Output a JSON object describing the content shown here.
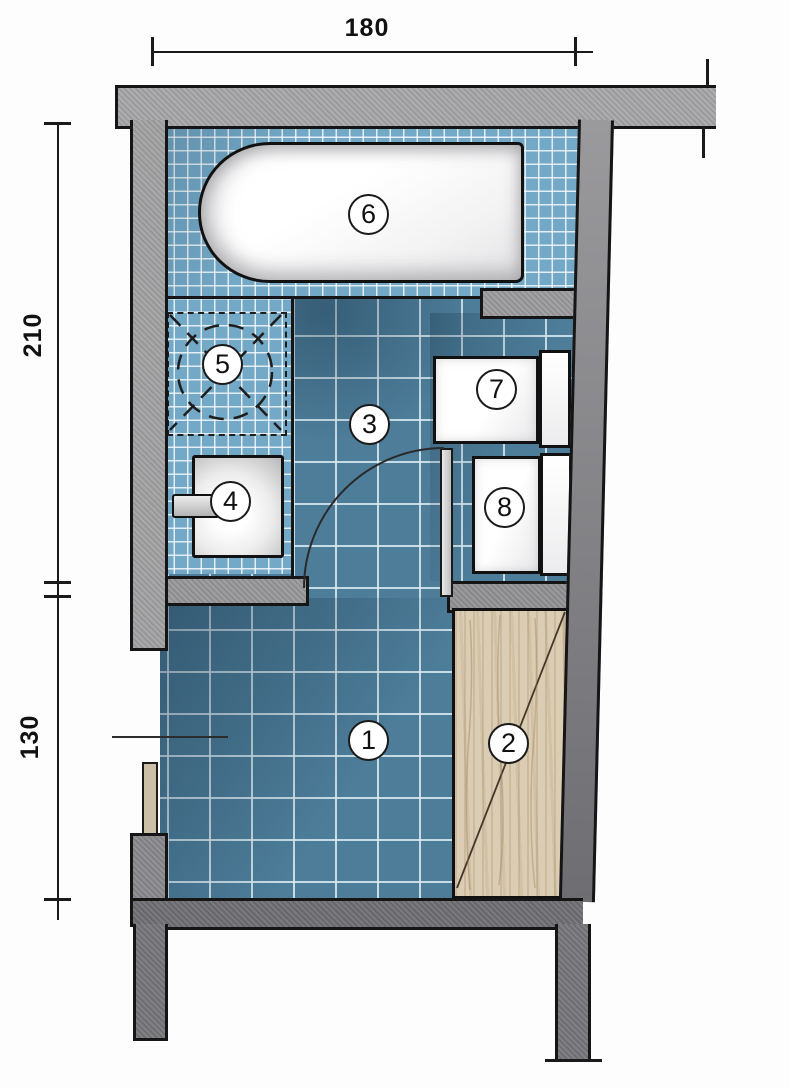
{
  "diagram": {
    "type": "bathroom-floor-plan",
    "dimensions": {
      "width_top": "180",
      "height_upper_left": "210",
      "height_lower_left": "130"
    },
    "markers": [
      {
        "number": "1",
        "item": "main-floor-area"
      },
      {
        "number": "2",
        "item": "wood-panel"
      },
      {
        "number": "3",
        "item": "upper-floor-area"
      },
      {
        "number": "4",
        "item": "washbasin"
      },
      {
        "number": "5",
        "item": "washing-machine"
      },
      {
        "number": "6",
        "item": "bathtub"
      },
      {
        "number": "7",
        "item": "toilet"
      },
      {
        "number": "8",
        "item": "bidet"
      }
    ],
    "colors": {
      "tile_light": "#73a8c6",
      "tile_dark": "#4d7d99",
      "grout": "#ffffff",
      "wall_light": "#a7a7a9",
      "wall_dark": "#707074",
      "wood": "#dbcdb3",
      "fixture_white": "#ffffff",
      "line_black": "#151515"
    }
  }
}
